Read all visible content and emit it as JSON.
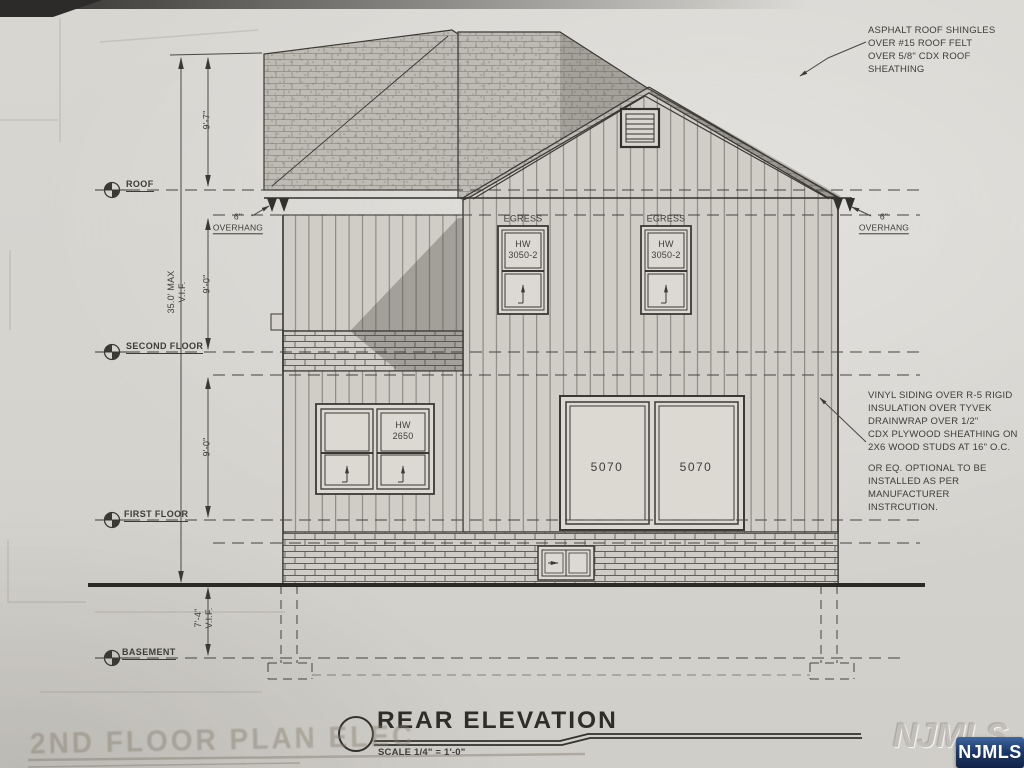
{
  "colors": {
    "paper": "#d5d3ce",
    "ink": "#3b3936",
    "watermark_navy": "#1d3a6b"
  },
  "titleblock": {
    "title": "REAR ELEVATION",
    "scale": "SCALE 1/4\" = 1'-0\""
  },
  "levels": {
    "roof": "ROOF",
    "second": "SECOND FLOOR",
    "first": "FIRST FLOOR",
    "basement": "BASEMENT"
  },
  "dimensions": {
    "ridge_to_roof": "9'-7\"",
    "roof_to_second": "9'-0\"",
    "second_to_first": "9'-0\"",
    "overall_max": "35.0' MAX\nV.I.F.",
    "grade_to_basement": "7'-4\"\nV.I.F."
  },
  "annotations": {
    "roof_note": "ASPHALT ROOF SHINGLES\nOVER #15 ROOF FELT\nOVER 5/8\" CDX ROOF\nSHEATHING",
    "siding_note": "VINYL SIDING  OVER R-5 RIGID\nINSULATION  OVER TYVEK\nDRAINWRAP OVER 1/2\"\nCDX PLYWOOD SHEATHING ON\n2X6  WOOD STUDS AT 16\" O.C.",
    "install_note": "OR EQ. OPTIONAL TO BE\nINSTALLED AS PER\nMANUFACTURER\nINSTRCUTION.",
    "overhang_left": "6\"\nOVERHANG",
    "overhang_right": "6\"\nOVERHANG"
  },
  "openings": {
    "egress_label": "EGRESS",
    "egress_size": "HW\n3050-2",
    "window_size": "HW\n2650",
    "door_size": "5070"
  },
  "ghost": {
    "underlay_title": "2ND FLOOR PLAN ELEC"
  },
  "watermark": {
    "label": "NJMLS"
  }
}
